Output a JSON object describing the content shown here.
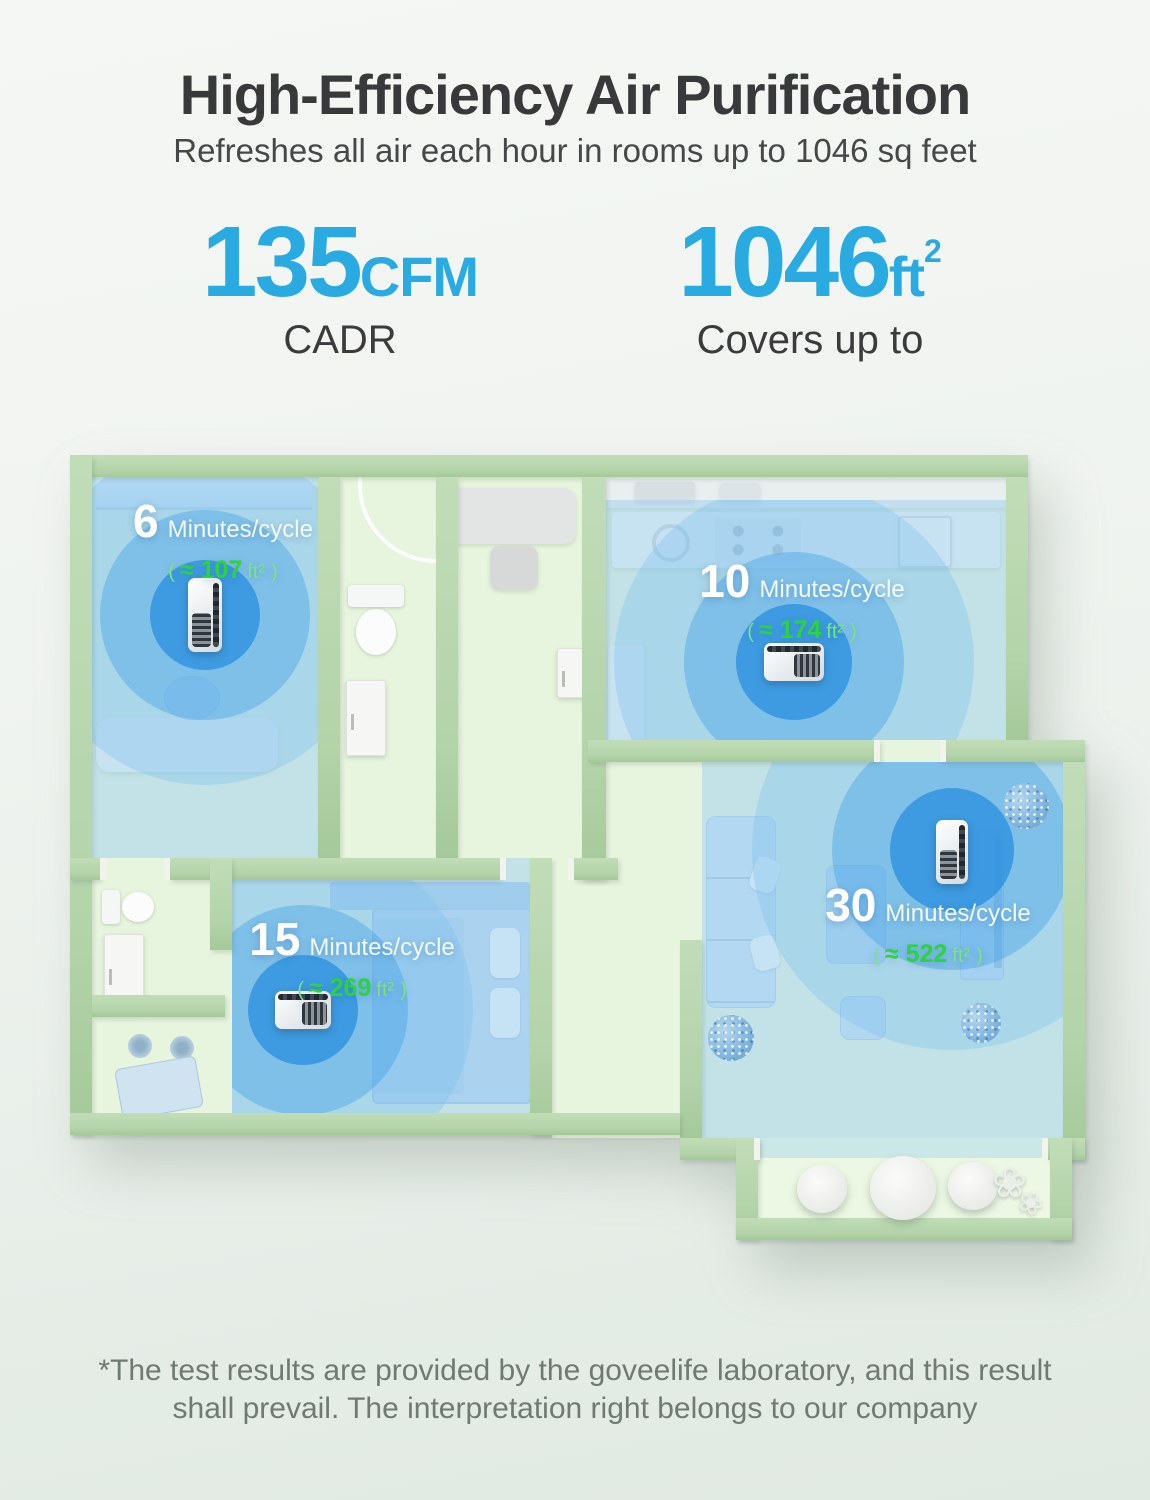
{
  "header": {
    "title": "High-Efficiency Air Purification",
    "subtitle": "Refreshes all air each hour in rooms up to 1046 sq feet"
  },
  "stats": [
    {
      "value": "135",
      "unit": "CFM",
      "sup": "",
      "label": "CADR"
    },
    {
      "value": "1046",
      "unit": "ft",
      "sup": "2",
      "label": "Covers up to"
    }
  ],
  "rooms": [
    {
      "name": "study",
      "minutes": "6",
      "cycle_label": "Minutes/cycle",
      "area_open": "(",
      "area_strong": "≈ 107",
      "area_unit": "ft²",
      "area_close": ")"
    },
    {
      "name": "kitchen",
      "minutes": "10",
      "cycle_label": "Minutes/cycle",
      "area_open": "(",
      "area_strong": "≈ 174",
      "area_unit": "ft²",
      "area_close": ")"
    },
    {
      "name": "bedroom",
      "minutes": "15",
      "cycle_label": "Minutes/cycle",
      "area_open": "(",
      "area_strong": "≈ 269",
      "area_unit": "ft²",
      "area_close": ")"
    },
    {
      "name": "living-room",
      "minutes": "30",
      "cycle_label": "Minutes/cycle",
      "area_open": "(",
      "area_strong": "≈ 522",
      "area_unit": "ft²",
      "area_close": ")"
    }
  ],
  "footnote": {
    "line1": "*The test results are provided by the goveelife laboratory, and this result",
    "line2": "shall prevail. The interpretation right belongs to our company"
  },
  "colors": {
    "accent_blue": "#29abe2",
    "highlight_green": "#2bd33c",
    "soft_green": "#7ae47e",
    "wall_green": "#b9d7b0",
    "floor_green": "#e7f4de",
    "coverage_blue": "#8fc6ec",
    "heading_gray": "#39393b",
    "footnote_gray": "#6e7a72"
  }
}
